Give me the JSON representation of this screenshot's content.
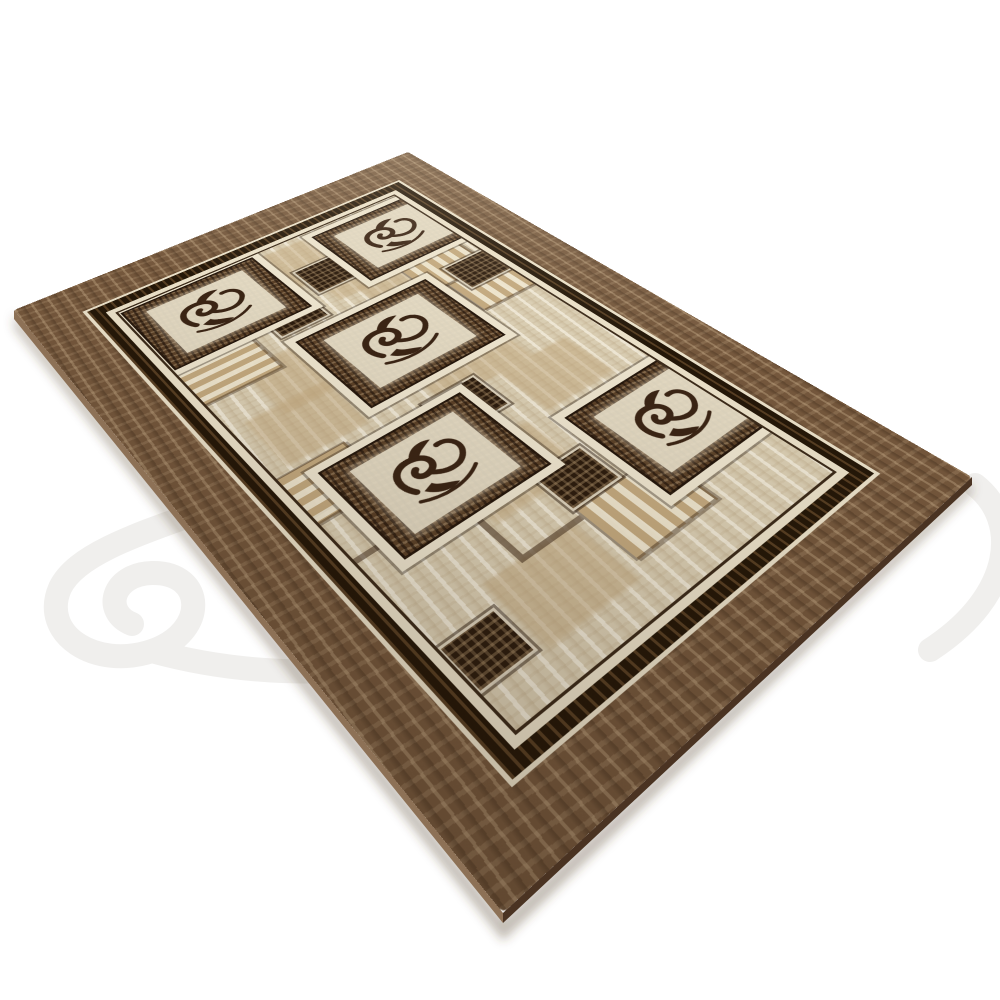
{
  "scene": {
    "description": "Product photo of a rectangular ornamental area rug shown in three-quarter perspective on a plain white background",
    "background": "#ffffff",
    "watermark": {
      "style": "faint embossed script flourish",
      "color": "#f0efed",
      "stroke_width": 24,
      "strokes": [
        "M310,465 C225,515 85,535 60,588 C40,634 95,670 152,651 C208,632 206,572 152,573 C112,574 102,612 132,624",
        "M152,651 C300,692 470,668 610,610",
        "M975,485 C1020,520 1015,595 930,650"
      ]
    }
  },
  "rug": {
    "corners": {
      "left": [
        14,
        310
      ],
      "top": [
        408,
        152
      ],
      "right": [
        972,
        477
      ],
      "bottom": [
        503,
        913
      ]
    },
    "local_size": [
      430,
      660
    ],
    "thickness_px": 10,
    "colors": {
      "background": "#ffffff",
      "border_brown": "#74573c",
      "dark_band": "#241708",
      "cream": "#eae0c8",
      "field_beige": "#d9cdb2",
      "tan": "#c2a87e",
      "medallion_dark": "#5a4027",
      "ornament_cream": "#ece3cd",
      "ornament_dark": "#3a2414",
      "watermark": "#f0efed",
      "rug_side_light": "#8d7156",
      "rug_side_dark": "#4a3322",
      "shadow": "rgba(85,65,45,0.35)"
    },
    "border_bands": {
      "outer_brown_width": 44,
      "cream_line": 3,
      "dark_band": 12,
      "inner_cream": 6,
      "inner_dark_line": 2
    },
    "pattern": {
      "medallions": [
        {
          "x": 0.2,
          "y": 0.09,
          "w": 0.44,
          "h": 0.2
        },
        {
          "x": 0.83,
          "y": 0.1,
          "w": 0.42,
          "h": 0.19
        },
        {
          "x": 0.52,
          "y": 0.36,
          "w": 0.46,
          "h": 0.21
        },
        {
          "x": 0.28,
          "y": 0.625,
          "w": 0.44,
          "h": 0.2
        },
        {
          "x": 0.845,
          "y": 0.77,
          "w": 0.42,
          "h": 0.2
        }
      ],
      "dark_squares": [
        {
          "x": 0.57,
          "y": 0.135,
          "w": 0.16,
          "h": 0.08
        },
        {
          "x": 0.37,
          "y": 0.2,
          "w": 0.15,
          "h": 0.075
        },
        {
          "x": 0.5,
          "y": 0.56,
          "w": 0.16,
          "h": 0.08
        },
        {
          "x": 0.53,
          "y": 0.775,
          "w": 0.15,
          "h": 0.075
        },
        {
          "x": 0.065,
          "y": 0.9,
          "w": 0.14,
          "h": 0.07
        },
        {
          "x": 0.92,
          "y": 0.3,
          "w": 0.15,
          "h": 0.075
        }
      ],
      "striped_squares": [
        {
          "x": 0.09,
          "y": 0.25,
          "w": 0.26,
          "h": 0.105,
          "dir": "h"
        },
        {
          "x": 0.91,
          "y": 0.35,
          "w": 0.22,
          "h": 0.1,
          "dir": "v"
        },
        {
          "x": 0.06,
          "y": 0.56,
          "w": 0.24,
          "h": 0.1,
          "dir": "h"
        },
        {
          "x": 0.59,
          "y": 0.87,
          "w": 0.26,
          "h": 0.105,
          "dir": "v"
        },
        {
          "x": 0.85,
          "y": 0.25,
          "w": 0.22,
          "h": 0.1,
          "dir": "v"
        }
      ],
      "outline_squares": [
        {
          "x": 0.04,
          "y": 0.64,
          "w": 0.2,
          "h": 0.09
        },
        {
          "x": 0.36,
          "y": 0.78,
          "w": 0.18,
          "h": 0.08
        }
      ],
      "tan_blocks": [
        {
          "x": 0.47,
          "y": 0.08,
          "w": 0.3,
          "h": 0.13
        },
        {
          "x": 0.72,
          "y": 0.27,
          "w": 0.26,
          "h": 0.12
        },
        {
          "x": 0.28,
          "y": 0.34,
          "w": 0.28,
          "h": 0.13
        },
        {
          "x": 0.62,
          "y": 0.48,
          "w": 0.3,
          "h": 0.13
        },
        {
          "x": 0.16,
          "y": 0.44,
          "w": 0.24,
          "h": 0.12
        },
        {
          "x": 0.44,
          "y": 0.71,
          "w": 0.28,
          "h": 0.12
        },
        {
          "x": 0.77,
          "y": 0.6,
          "w": 0.24,
          "h": 0.11
        },
        {
          "x": 0.3,
          "y": 0.89,
          "w": 0.26,
          "h": 0.12
        },
        {
          "x": 0.63,
          "y": 0.17,
          "w": 0.22,
          "h": 0.1
        }
      ]
    }
  }
}
